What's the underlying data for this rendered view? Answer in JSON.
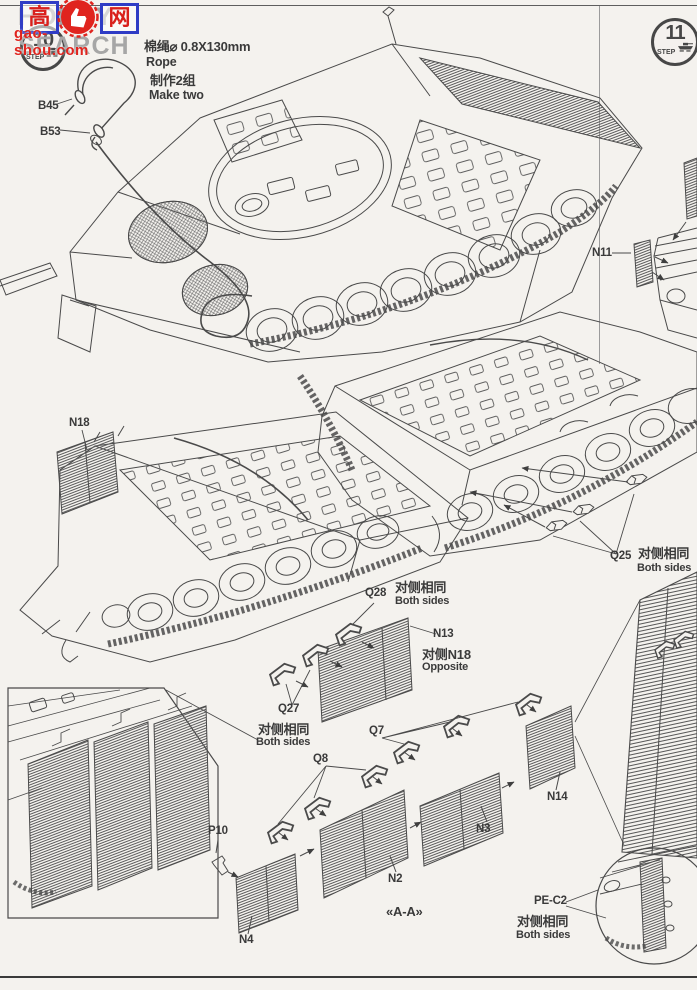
{
  "page": {
    "background": "#f4f2ee",
    "ink": "#4a4a4a"
  },
  "watermark": {
    "char_left": "高",
    "char_right": "网",
    "domain_text": "gao-shou.com",
    "shop_text": "HOBBY SEARCH",
    "red": "#e0241e",
    "blue": "#2f3cc5",
    "grey": "#a6a6a6"
  },
  "steps": {
    "left": {
      "number": "10",
      "label": "STEP"
    },
    "right": {
      "number": "11",
      "label": "STEP"
    }
  },
  "rope_note": {
    "line1": "棉绳⌀ 0.8X130mm",
    "line2": "Rope",
    "line3": "制作2组",
    "line4": "Make two"
  },
  "labels": {
    "b45": "B45",
    "b53": "B53",
    "n11": "N11",
    "n18": "N18",
    "q25": "Q25",
    "q28": "Q28",
    "q27": "Q27",
    "n13": "N13",
    "q7": "Q7",
    "q8": "Q8",
    "p10": "P10",
    "n4": "N4",
    "n2": "N2",
    "n3": "N3",
    "n14": "N14",
    "pe_c2": "PE-C2"
  },
  "notes": {
    "both_sides": {
      "cn": "对侧相同",
      "en": "Both sides"
    },
    "opposite": {
      "cn": "对侧N18",
      "en": "Opposite"
    },
    "section": "«A-A»"
  }
}
